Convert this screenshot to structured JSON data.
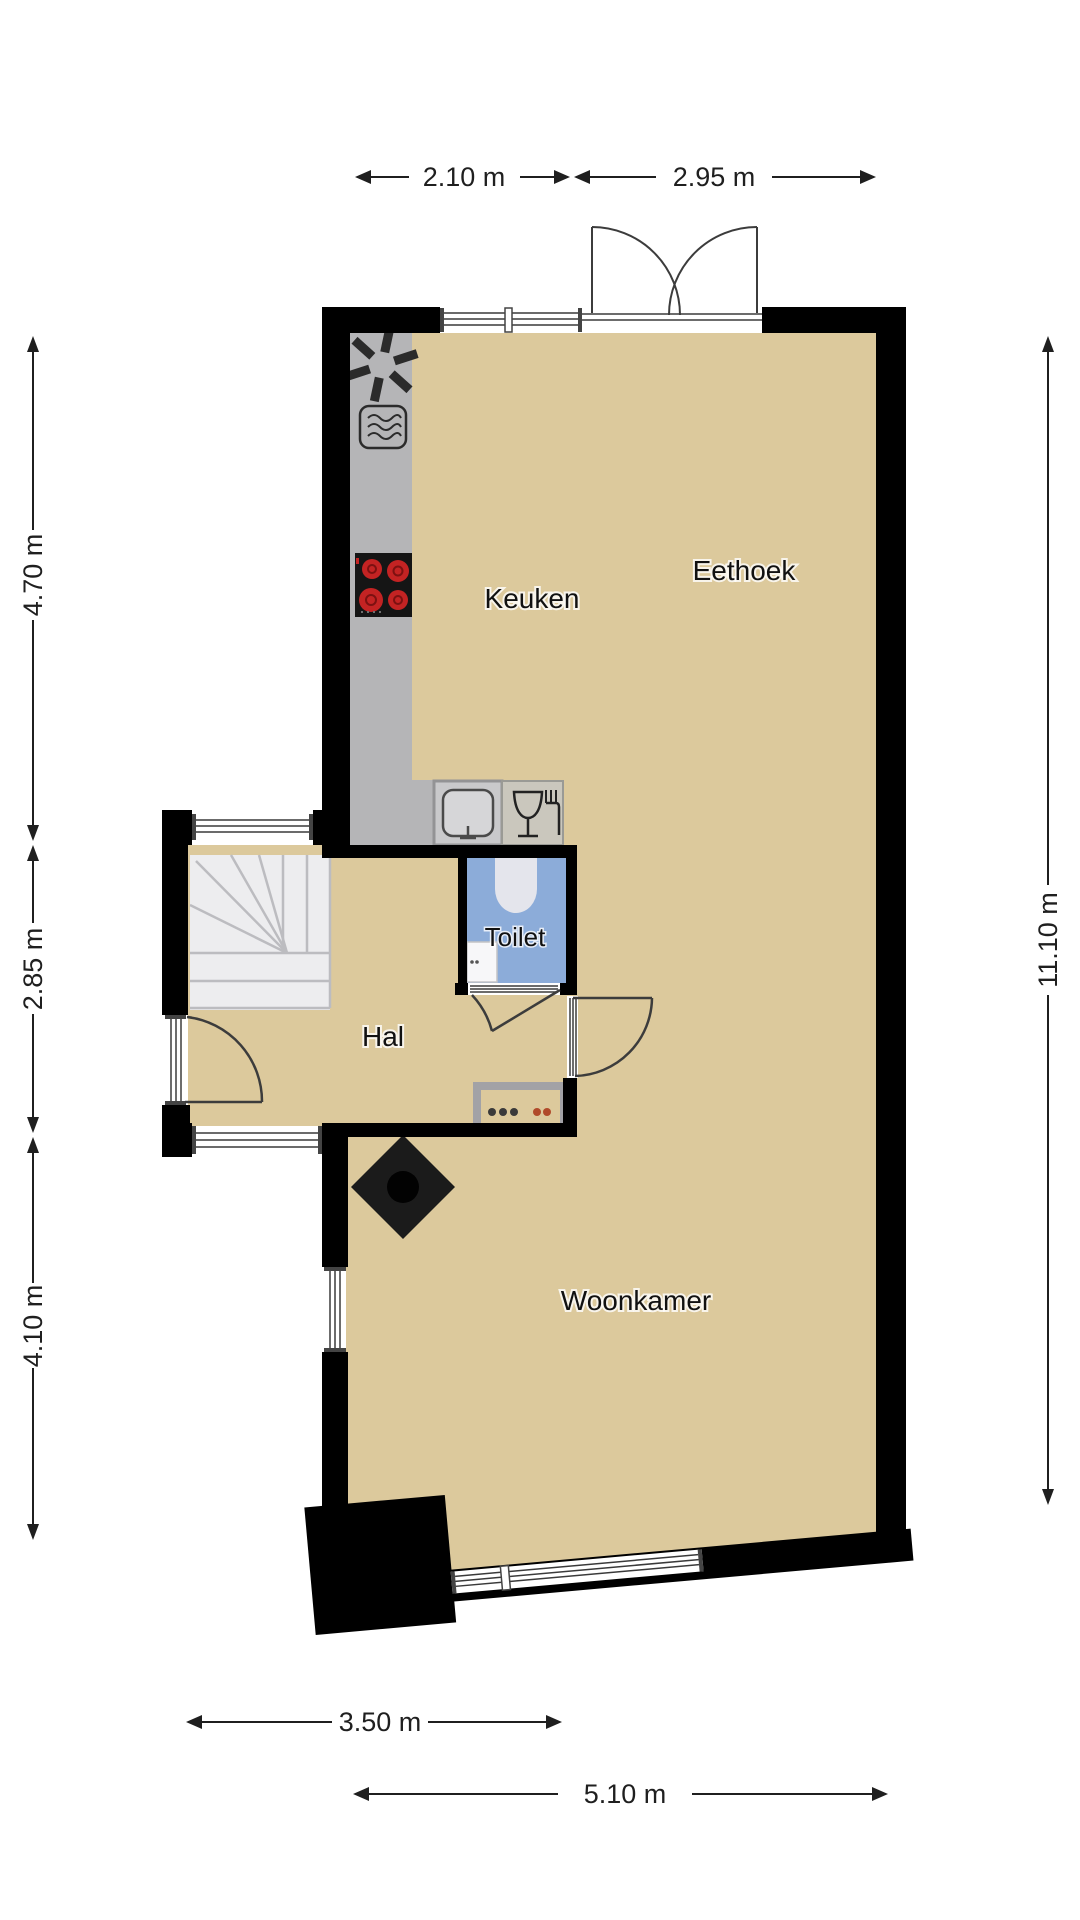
{
  "floorplan": {
    "type": "floor-plan",
    "rooms": {
      "keuken": "Keuken",
      "eethoek": "Eethoek",
      "toilet": "Toilet",
      "hal": "Hal",
      "woonkamer": "Woonkamer"
    },
    "dimensions": {
      "top_left": "2.10 m",
      "top_right": "2.95 m",
      "left_top": "4.70 m",
      "left_middle": "2.85 m",
      "left_bottom": "4.10 m",
      "right_side": "11.10 m",
      "bottom_hall": "3.50 m",
      "bottom_living": "5.10 m"
    },
    "fixtures": {
      "fan": "fan-icon",
      "oven": "oven-icon",
      "cooktop": "cooktop-4-burners",
      "sink": "kitchen-sink",
      "dishwasher": "glass-fork-icon",
      "toilet_bowl": "toilet-bowl",
      "hand_basin": "hand-basin",
      "stairs": "winder-staircase",
      "chimney": "chimney-diamond",
      "radiator": "radiator",
      "front_door": "front-door",
      "toilet_door": "toilet-door",
      "living_door": "living-room-door",
      "french_doors": "double-french-doors"
    },
    "colors": {
      "floor": "#dcc99c",
      "toilet_floor": "#8cacd9",
      "wall": "#000000",
      "counter": "#b5b5b7",
      "counter_light": "#d6d6d8",
      "sink_zone": "#c9c9cb",
      "dw_zone": "#cac7bd",
      "stairs": "#ededef",
      "burner": "#c32323",
      "icon": "#2b2b2b",
      "dim": "#1f1f1f",
      "label": "#111111"
    }
  }
}
